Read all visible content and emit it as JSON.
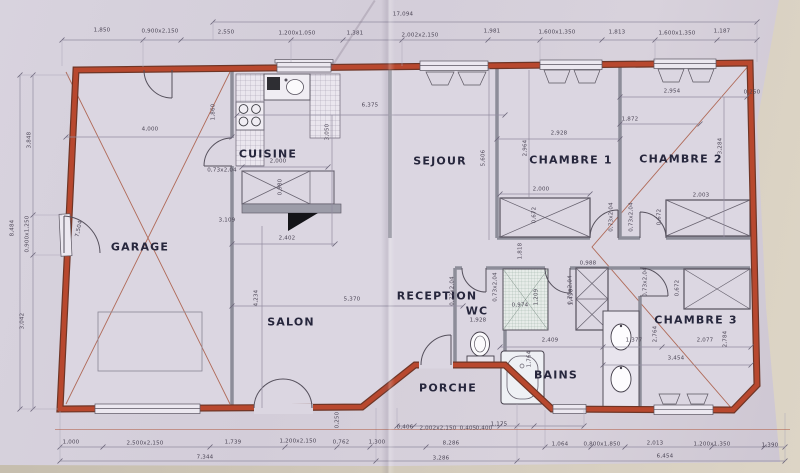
{
  "rooms": {
    "garage": "GARAGE",
    "cuisine": "CUISINE",
    "sejour": "SEJOUR",
    "chambre1": "CHAMBRE 1",
    "chambre2": "CHAMBRE 2",
    "chambre3": "CHAMBRE 3",
    "salon": "SALON",
    "reception": "RECEPTION",
    "wc": "WC",
    "bains": "BAINS",
    "porche": "PORCHE"
  },
  "dims": {
    "total_width": "17,094",
    "top": [
      "1,850",
      "0,900x2,150",
      "2,550",
      "1,200x1,050",
      "1,381",
      "2,002x2,150",
      "1,981",
      "1,600x1,350",
      "1,813",
      "1,600x1,350",
      "1,187"
    ],
    "left": [
      "3,848",
      "8,484",
      "0,900x1,250",
      "3,042",
      "7,504"
    ],
    "bottom_upper": [
      "0,406",
      "2,002x2,150",
      "0,405",
      "0,400",
      "1,175"
    ],
    "bottom_mid": [
      "1,000",
      "2,500x2,150",
      "1,739",
      "1,200x2,150",
      "0,762",
      "1,300",
      "8,286",
      "1,064",
      "0,800x1,850",
      "2,013",
      "1,200x1,350",
      "1,390"
    ],
    "bottom_lower": [
      "7,344",
      "3,286",
      "6,454"
    ],
    "interior": [
      "4,000",
      "1,860",
      "6,375",
      "3,050",
      "2,000",
      "0,980",
      "3,109",
      "2,402",
      "5,370",
      "4,234",
      "5,606",
      "0,250"
    ],
    "chambre1": [
      "2,928",
      "2,964",
      "2,000",
      "0,672",
      "1,818"
    ],
    "chambre2": [
      "2,954",
      "0,250",
      "1,872",
      "3,284",
      "2,003",
      "0,672",
      "0,672"
    ],
    "chambre3": [
      "1,377",
      "2,764",
      "2,077",
      "2,784",
      "3,454"
    ],
    "wc": [
      "1,928"
    ],
    "bains": [
      "2,409",
      "1,764",
      "0,974",
      "1,209",
      "0,988",
      "1,450"
    ],
    "door_label": "0,73x2,04"
  },
  "colors": {
    "exterior_wall": "#b8482e",
    "interior_wall": "#8d8d99",
    "paper": "#d5cfda",
    "background": "#cdc5b5"
  }
}
